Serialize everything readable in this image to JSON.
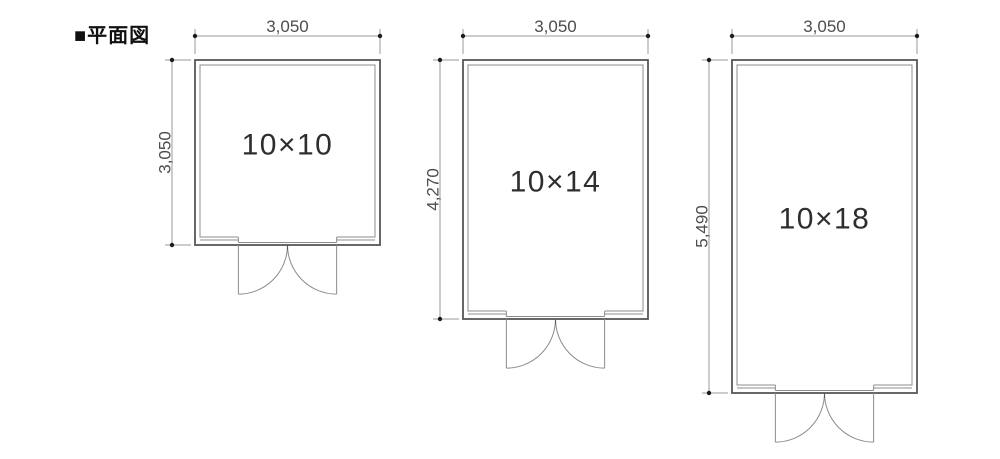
{
  "page": {
    "title": "■平面図",
    "background": "#ffffff"
  },
  "drawing": {
    "plans": [
      {
        "name": "10×10",
        "width_label": "3,050",
        "depth_label": "3,050",
        "width_mm": 3050,
        "depth_mm": 3050
      },
      {
        "name": "10×14",
        "width_label": "3,050",
        "depth_label": "4,270",
        "width_mm": 3050,
        "depth_mm": 4270
      },
      {
        "name": "10×18",
        "width_label": "3,050",
        "depth_label": "5,490",
        "width_mm": 3050,
        "depth_mm": 5490
      }
    ],
    "colors": {
      "wall": "#575757",
      "inner_wall": "#8c8c8c",
      "door": "#8c8c8c",
      "dimension_line": "#999999",
      "dimension_dot": "#1c1c1c",
      "dimension_text": "#4d4d4d",
      "size_text": "#2e2e2e"
    }
  }
}
